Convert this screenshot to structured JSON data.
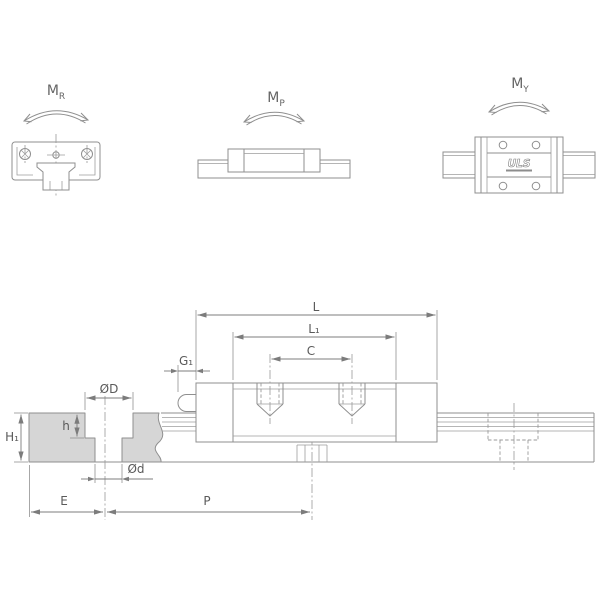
{
  "moments": [
    {
      "letter": "M",
      "sub": "R"
    },
    {
      "letter": "M",
      "sub": "P"
    },
    {
      "letter": "M",
      "sub": "Y"
    }
  ],
  "dimensions": {
    "L": "L",
    "L1": "L₁",
    "C": "C",
    "G1": "G₁",
    "OD": "ØD",
    "h": "h",
    "H1": "H₁",
    "Od": "Ød",
    "E": "E",
    "P": "P"
  },
  "brand": {
    "logo": "ULS"
  },
  "colors": {
    "line": "#8f8f8f",
    "dimension": "#7c7c7c",
    "text": "#5a5a5a",
    "section_fill": "#d6d6d6",
    "background": "#ffffff"
  }
}
